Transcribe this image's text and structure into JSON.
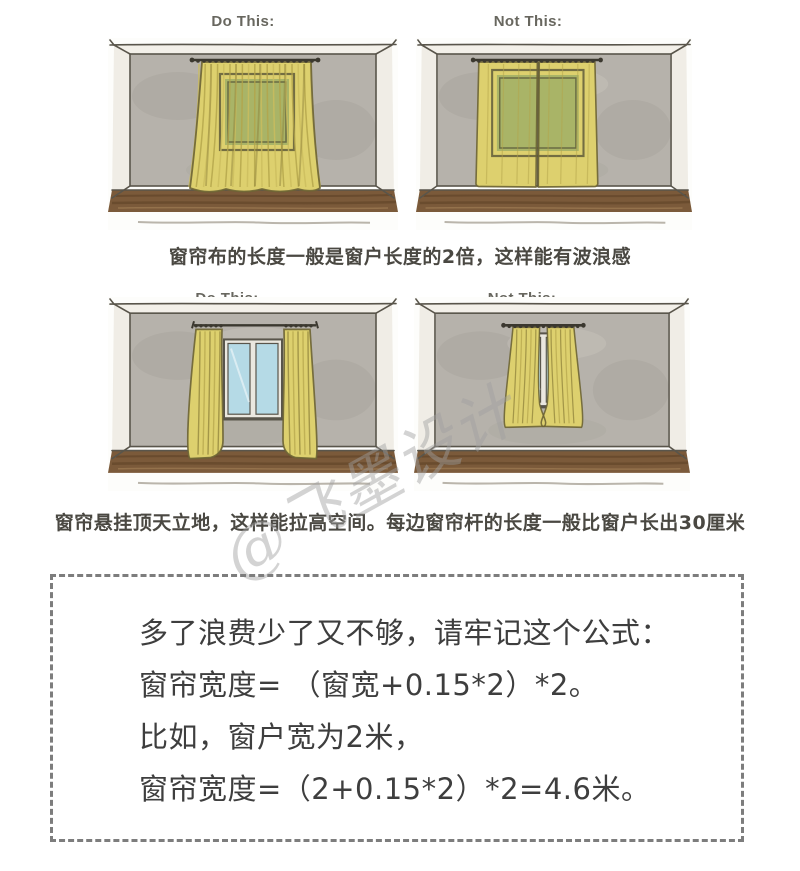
{
  "panels": [
    {
      "header": "Do This:"
    },
    {
      "header": "Not This:"
    },
    {
      "header": "Do This:"
    },
    {
      "header": "Not This:"
    }
  ],
  "captions": {
    "row1": "窗帘布的长度一般是窗户长度的2倍，这样能有波浪感",
    "row2": "窗帘悬挂顶天立地，这样能拉高空间。每边窗帘杆的长度一般比窗户长出30厘米"
  },
  "formula_box": {
    "lines": [
      "多了浪费少了又不够，请牢记这个公式：",
      "窗帘宽度= （窗宽+0.15*2）*2。",
      "比如，窗户宽为2米，",
      "窗帘宽度=（2+0.15*2）*2=4.6米。"
    ]
  },
  "watermark": {
    "text": "@飞墨设计"
  },
  "colors": {
    "paper": "#fdfdfb",
    "ceiling": "#f3f0e9",
    "sidewall": "#f0ede6",
    "wall": "#b6b2ab",
    "wall_shade": "#9d998f",
    "floor": "#7b5a3a",
    "floor_dark": "#573b22",
    "floor_light": "#a58258",
    "outline": "#59554b",
    "curtain": "#ddd06e",
    "curtain_stripe": "#b3a44a",
    "curtain_stripe_light": "#ccbd5e",
    "curtain_fold": "#8a7d38",
    "curtain_outline": "#6d6434",
    "window_green": "#7e9c63",
    "window_blue": "#b5dae6",
    "rod": "#3b382f",
    "header_text": "#68675f",
    "caption_text": "#4a4842",
    "formula_text": "#3e3e3e",
    "box_border": "#7d7d7d",
    "watermark": "#a0a0a0"
  }
}
